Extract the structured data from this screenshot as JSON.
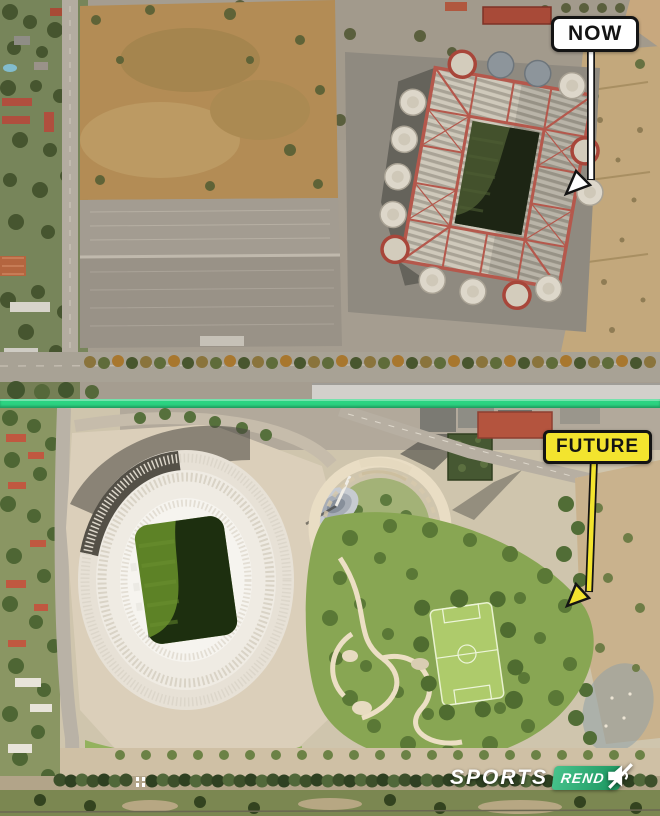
{
  "page": {
    "width_px": 660,
    "height_px": 816,
    "description": "Before/after aerial comparison of the San Siro stadium site: satellite photo labelled NOW on top, architectural render labelled FUTURE below, separated by a bright green divider bar."
  },
  "panels": {
    "now": {
      "label": "NOW",
      "scene": "Satellite photo: current stadium with red roof lattice, white spiral ramp towers, dark pitch, large grey parking lots, brown dirt field, tree-lined avenue and dirt ground on the right"
    },
    "future": {
      "label": "FUTURE",
      "scene": "Render: new oval stadium with cream roof and sunken green pitch, surrounding plaza, circular helix plaza with spire, high-rise buildings, rooftop park with elevated football pitch, winding paths and tree-lined boulevard"
    }
  },
  "watermark": {
    "brand": "SPORTS",
    "badge": "REND",
    "icon": "muted-speaker"
  },
  "colors": {
    "divider-green": "#2bd381",
    "future-yellow": "#f3e42e",
    "now-white": "#ffffff",
    "label-black": "#141414",
    "badge-green": "#1fb573",
    "stadium-red": "#b5584c",
    "pitch-green": "#43512c"
  }
}
